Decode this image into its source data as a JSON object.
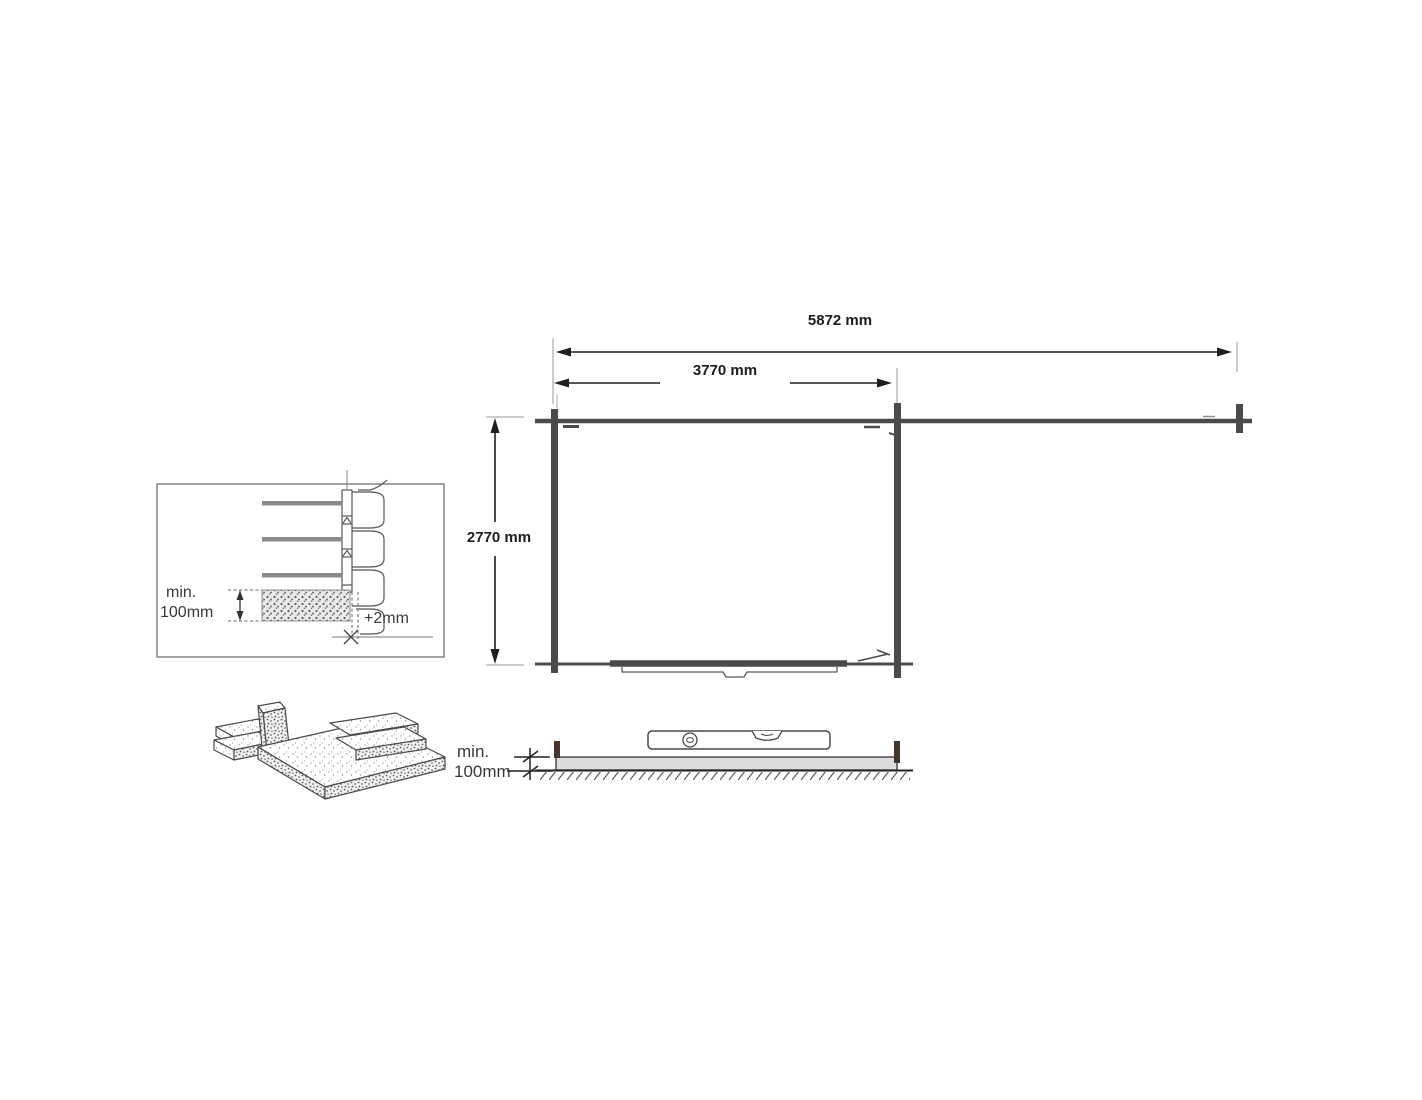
{
  "plan": {
    "dim_total_width": "5872 mm",
    "dim_inner_width": "3770 mm",
    "dim_depth": "2770 mm"
  },
  "wall_base_detail": {
    "min_height_line1": "min.",
    "min_height_line2": "100mm",
    "expansion_gap": "+2mm"
  },
  "foundation_section": {
    "min_thickness_line1": "min.",
    "min_thickness_line2": "100mm"
  },
  "colors": {
    "wall_line": "#4a4a4a",
    "dim_line": "#1f1f1f",
    "extension_line": "#999999",
    "slab_fill": "#dcdcdc",
    "peg_brown": "#46352a",
    "log_gray": "#8a8a8a",
    "text_dark": "#1c1c1c",
    "text_note": "#3a3a3a"
  }
}
